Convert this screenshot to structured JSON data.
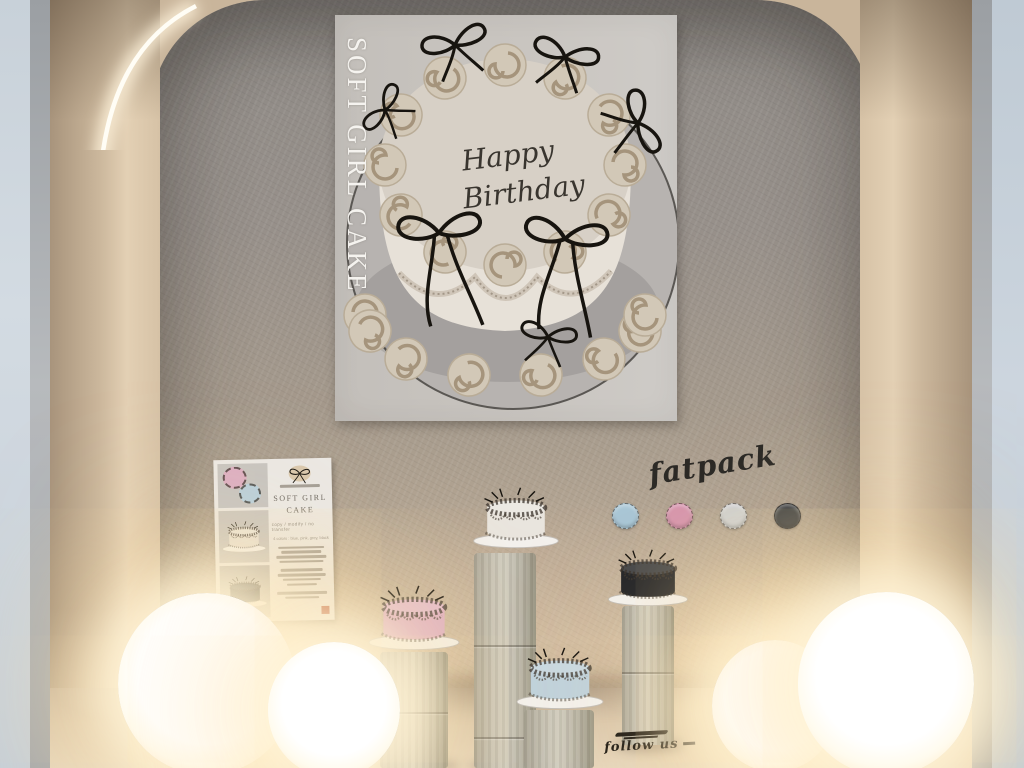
{
  "main_poster": {
    "vertical_title": "SOFT GIRL CAKE",
    "message_line1": "Happy",
    "message_line2": "Birthday"
  },
  "info_poster": {
    "title_line1": "SOFT GIRL",
    "title_line2": "CAKE",
    "perms": "copy / modify / no transfer",
    "colors_line": "4 colors : blue, pink, grey, black"
  },
  "fatpack": {
    "label": "fatpack",
    "swatches": [
      {
        "name": "blue",
        "color": "#a9c6d5"
      },
      {
        "name": "pink",
        "color": "#d694ad"
      },
      {
        "name": "grey",
        "color": "#cfd0cf"
      },
      {
        "name": "black",
        "color": "#3a3d40"
      }
    ]
  },
  "floor_note": "follow us",
  "cakes": [
    {
      "name": "white",
      "color": "#e9e5de"
    },
    {
      "name": "black",
      "color": "#232427"
    },
    {
      "name": "pink",
      "color": "#dfb0c4"
    },
    {
      "name": "blue",
      "color": "#bfd2dd"
    }
  ]
}
